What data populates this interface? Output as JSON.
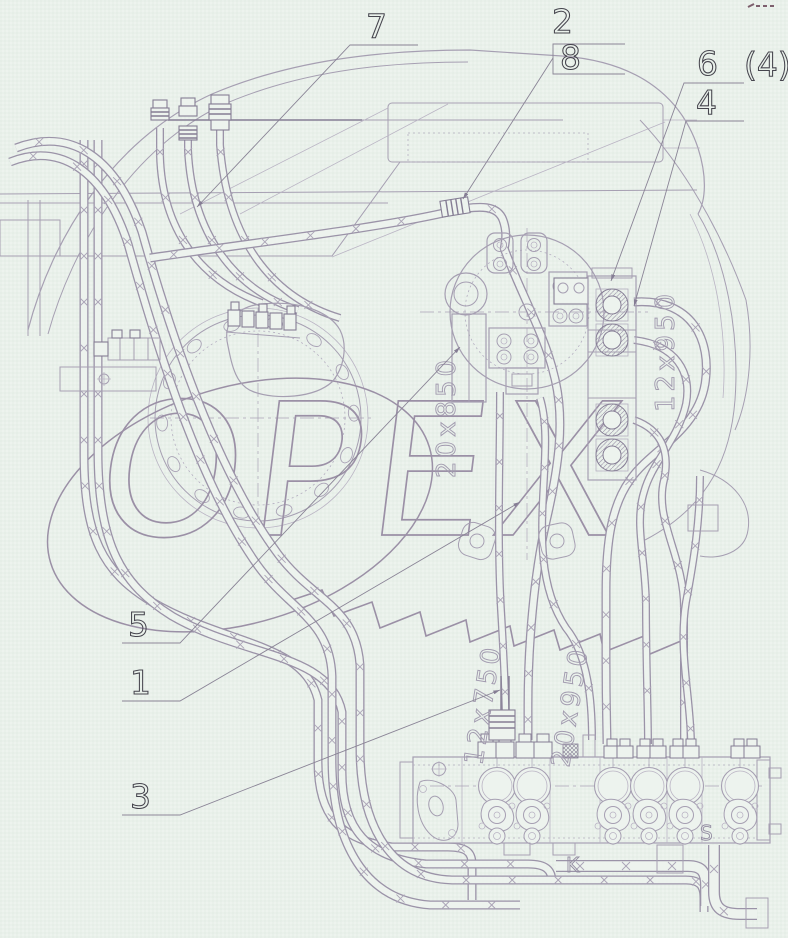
{
  "diagram": {
    "type": "hydraulic-piping-engineering-drawing",
    "watermark": "ОРЕХ",
    "callouts": {
      "n7": "7",
      "n2": "2",
      "n8": "8",
      "n6": "6",
      "n4_paren": "(4)",
      "n4": "4",
      "n5": "5",
      "n1": "1",
      "n3": "3"
    },
    "hose_size_labels": {
      "center_vertical": "20x850",
      "right_loop": "12x950",
      "bottom_left": "12x750",
      "bottom_center": "20x950"
    },
    "port_letters": {
      "k": "K",
      "s": "S"
    },
    "colors": {
      "background": "#edf3ee",
      "line": "#a69fb2",
      "dark_line": "#857d94",
      "watermark": "#9b90a6",
      "callout_text": "#46454e",
      "label_text": "#a29baf"
    }
  }
}
